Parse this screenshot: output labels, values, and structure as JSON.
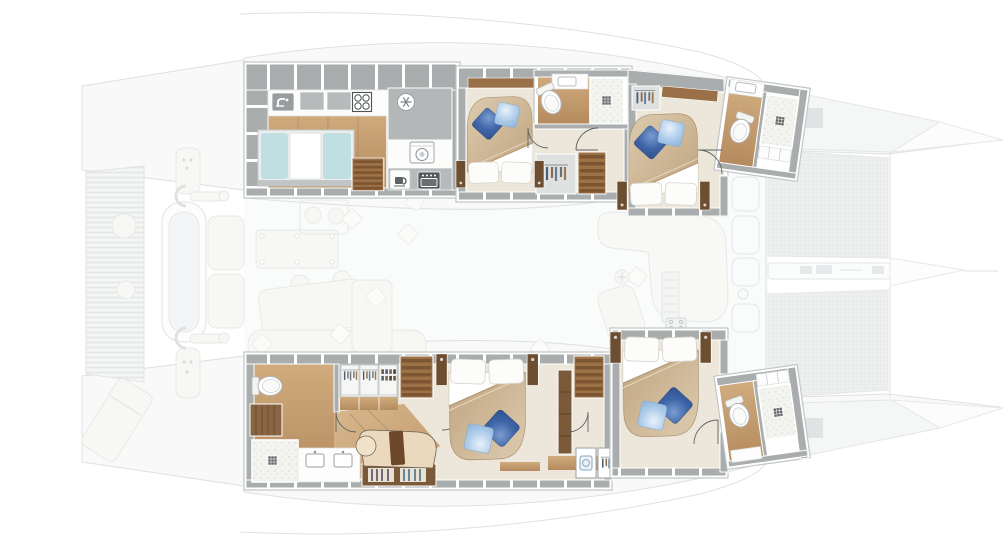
{
  "meta": {
    "title": "catamaran-interior-floor-plan",
    "view": "top-down",
    "style": "rendered-architectural-plan",
    "highlighted_layer": "lower-deck hull accommodations (full opacity)",
    "ghosted_layer": "main deck, cockpit, foredeck and trampolines (faded)"
  },
  "colors": {
    "page_bg": "#ffffff",
    "ghost_line": "#d8dcde",
    "ghost_fill": "#f8f9f9",
    "wall_gray": "#a9adad",
    "room_outline": "#c2c6c6",
    "floor_beige": "#ece7da",
    "wood_light": "#cfab7e",
    "wood_mid": "#b48b5e",
    "wood_dark": "#7b5a39",
    "counter_white": "#fdfdfd",
    "steel_gray": "#b6baba",
    "cushion_cyan": "#bfdfe2",
    "duvet_beige": "#d2bd9d",
    "pillow_white": "#fbfbfa",
    "pillow_blue_dark": "#3f66a8",
    "pillow_blue_light": "#a9c9e8",
    "mesh_gray": "#ecedee",
    "deck_square_gray": "#dcdedf",
    "shower_floor": "#f3f3f0",
    "drain_gray": "#646668",
    "door_arc": "#5f6365"
  },
  "counts": {
    "cabins": 4,
    "ensuite_bathrooms": 4,
    "double_beds": 4,
    "galley": 1,
    "walk_in_closet": 1
  },
  "icons": [
    {
      "name": "faucet-icon"
    },
    {
      "name": "stove-burners-icon"
    },
    {
      "name": "snowflake-fridge-icon"
    },
    {
      "name": "washing-machine-icon"
    },
    {
      "name": "coffee-machine-icon"
    },
    {
      "name": "oven-icon"
    },
    {
      "name": "hanging-clothes-icon"
    },
    {
      "name": "shoe-rack-icon"
    },
    {
      "name": "shower-drain-icon"
    },
    {
      "name": "toilet"
    },
    {
      "name": "door-swing-arc"
    },
    {
      "name": "stairs"
    }
  ],
  "rooms": [
    {
      "id": "galley",
      "position": "port-hull-aft",
      "features": [
        "counter-with-sink",
        "cooktop-4-burner",
        "refrigerator",
        "washing-machine",
        "coffee-machine",
        "oven",
        "berth-with-cyan-cushions",
        "wood-floor",
        "companionway-steps"
      ]
    },
    {
      "id": "guest-cabin-port-aft",
      "position": "port-hull-mid",
      "features": [
        "double-bed",
        "white-pillows",
        "blue-accent-pillows",
        "wardrobe",
        "companionway-steps",
        "ensuite-bathroom",
        "toilet",
        "shower",
        "vanity"
      ]
    },
    {
      "id": "guest-cabin-port-forward",
      "position": "port-hull-bow",
      "features": [
        "double-bed",
        "wardrobe",
        "shelf",
        "ensuite-bathroom",
        "toilet",
        "shower",
        "sink",
        "cabinets"
      ]
    },
    {
      "id": "owner-suite",
      "position": "starboard-hull-aft",
      "features": [
        "double-bed",
        "chaise-sofa",
        "bookshelf",
        "walk-in-closet",
        "shoe-rack",
        "dresser",
        "vanity-two-sinks",
        "toilet",
        "shower",
        "desk",
        "wood-stairs",
        "tall-wardrobe",
        "utility-closet"
      ]
    },
    {
      "id": "guest-cabin-starboard-forward",
      "position": "starboard-hull-bow",
      "features": [
        "double-bed",
        "ensuite-bathroom",
        "toilet",
        "shower",
        "storage-cabinets",
        "companionway-steps"
      ]
    }
  ],
  "ghosted_deck_elements": [
    "aft-slatted-platform",
    "round-tables",
    "sun-lounger",
    "dinghy-on-davits",
    "cockpit-deck-panels",
    "cockpit-table",
    "dining-table",
    "chairs",
    "scatter-pillows",
    "salon-l-sofa",
    "galley-island",
    "companionway-steps",
    "grill",
    "mast-foot",
    "side-deck-hatches",
    "foredeck-lockers",
    "trampoline-nets",
    "bowsprit",
    "anchor-windlass",
    "hull-bows"
  ]
}
